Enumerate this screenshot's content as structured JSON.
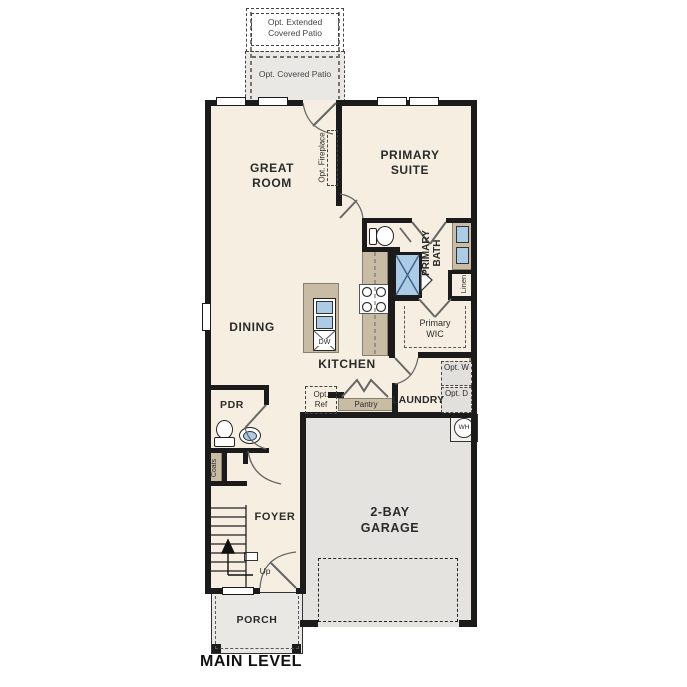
{
  "colors": {
    "wall": "#1b1b1b",
    "floor": "#f6efe1",
    "patio": "#eae8e4",
    "garage": "#e4e3e0",
    "counter": "#c9bca4",
    "fixture": "#abcbe7"
  },
  "labels": {
    "opt_extended_patio": "Opt. Extended Covered Patio",
    "opt_covered_patio": "Opt. Covered Patio",
    "great_room": "GREAT ROOM",
    "opt_fireplace": "Opt. Fireplace",
    "primary_suite": "PRIMARY SUITE",
    "primary_bath": "PRIMARY BATH",
    "primary_wic": "Primary WIC",
    "linen": "Linen",
    "dining": "DINING",
    "kitchen": "KITCHEN",
    "dishwasher": "DW",
    "opt_ref": "Opt. Ref",
    "pantry": "Pantry",
    "laundry": "LAUNDRY",
    "opt_washer": "Opt. W",
    "opt_dryer": "Opt. D",
    "water_heater": "WH",
    "powder_room": "PDR",
    "coats": "Coats",
    "foyer": "FOYER",
    "stairs_up": "Up",
    "garage": "2-BAY GARAGE",
    "porch": "PORCH",
    "main_level": "MAIN LEVEL"
  }
}
